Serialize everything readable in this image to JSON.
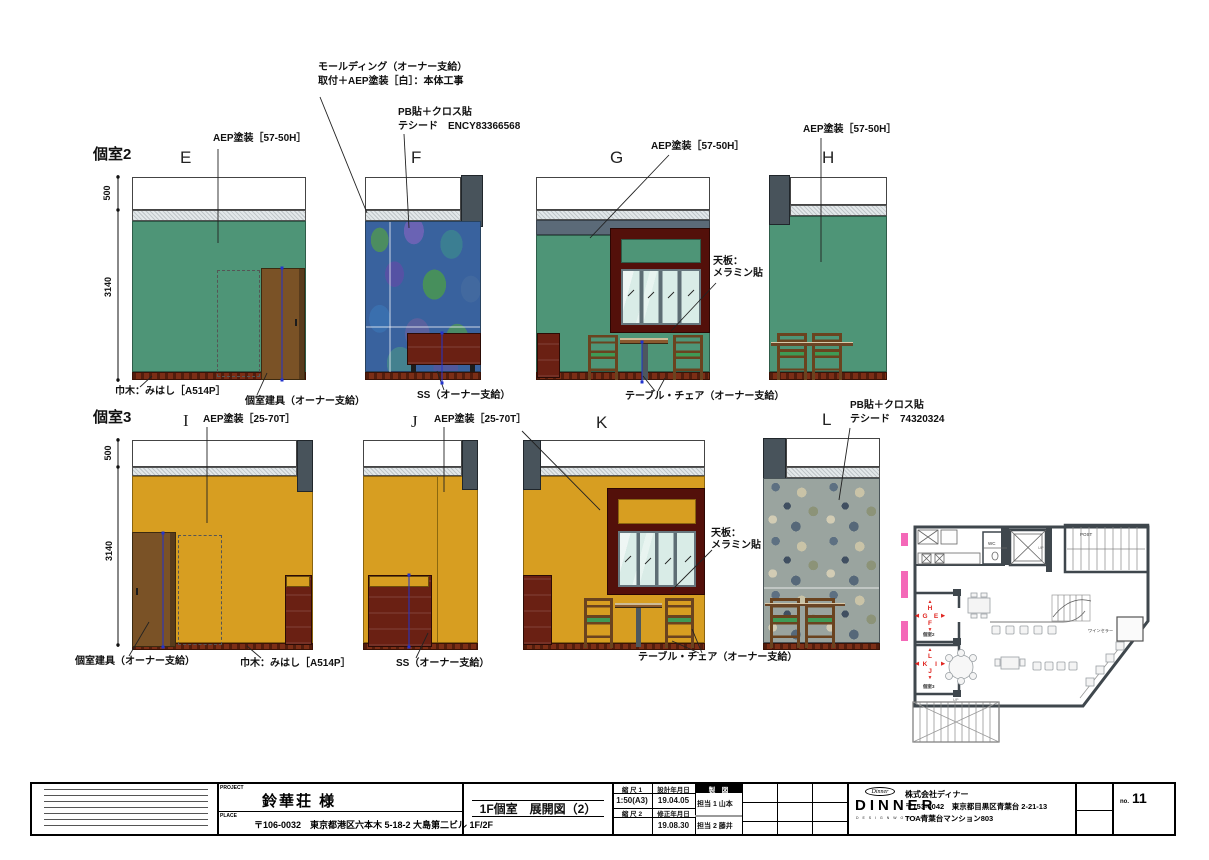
{
  "sheet": {
    "room2_label": "個室2",
    "room3_label": "個室3",
    "elevations": {
      "e": "E",
      "f": "F",
      "g": "G",
      "h": "H",
      "i": "I",
      "j": "J",
      "k": "K",
      "l": "L"
    }
  },
  "annotations": {
    "molding_1": "モールディング（オーナー支給）",
    "molding_2": "取付＋AEP塗装［白］：本体工事",
    "pb_f_1": "PB貼＋クロス貼",
    "pb_f_2": "テシード　ENCY83366568",
    "aep_57_50h": "AEP塗装［57-50H］",
    "aep_25_70t": "AEP塗装［25-70T］",
    "tenban_1": "天板：",
    "tenban_2": "メラミン貼",
    "table_chair": "テーブル・チェア（オーナー支給）",
    "habaki": "巾木：みはし［A514P］",
    "door": "個室建具（オーナー支給）",
    "ss": "SS（オーナー支給）",
    "pb_l_1": "PB貼＋クロス貼",
    "pb_l_2": "テシード　74320324"
  },
  "dimensions": {
    "h500": "500",
    "h3140": "3140",
    "d2000": "2000",
    "d850": "850",
    "d750": "750",
    "d1250": "1250"
  },
  "plan": {
    "post": "POST",
    "wc": "WC",
    "wine_cellar": "ワインセラー",
    "up": "UP",
    "markers": {
      "e": "E",
      "f": "F",
      "g": "G",
      "h": "H",
      "i": "I",
      "j": "J",
      "k": "K",
      "l": "L"
    },
    "arrows": {
      "up": "▲",
      "down": "▼",
      "left": "◀",
      "right": "▶"
    }
  },
  "title_block": {
    "project_label": "PROJECT",
    "project_name": "鈴華荘 様",
    "place_label": "PLACE",
    "place": "〒106-0032　東京都港区六本木 5-18-2 大島第二ビル 1F/2F",
    "drawing_title": "1F個室　展開図（2）",
    "scale1_label": "縮 尺 1",
    "scale1": "1:50(A3)",
    "scale2_label": "縮 尺 2",
    "scale2": "",
    "design_date_label": "設計年月日",
    "design_date": "19.04.05",
    "revision_date_label": "修正年月日",
    "revision_date": "19.08.30",
    "drafting_label": "製　図",
    "staff1": "担当 1 山本",
    "staff2": "担当 2 藤井",
    "logo_script": "Dinner",
    "logo_text": "DINNER",
    "logo_sub": "D E S I G N W O R K S",
    "company_name": "株式会社ディナー",
    "company_addr1": "〒153-0042　東京都目黒区青葉台 2-21-13",
    "company_addr2": "TOA青葉台マンション803",
    "sheet_no_label": "no.",
    "sheet_no": "11"
  },
  "colors": {
    "wall_green": "#4E9577",
    "wall_mustard": "#D79E21",
    "dim_blue": "#2233CC",
    "marker_red": "#E02520",
    "accent_pink": "#F468B8"
  }
}
